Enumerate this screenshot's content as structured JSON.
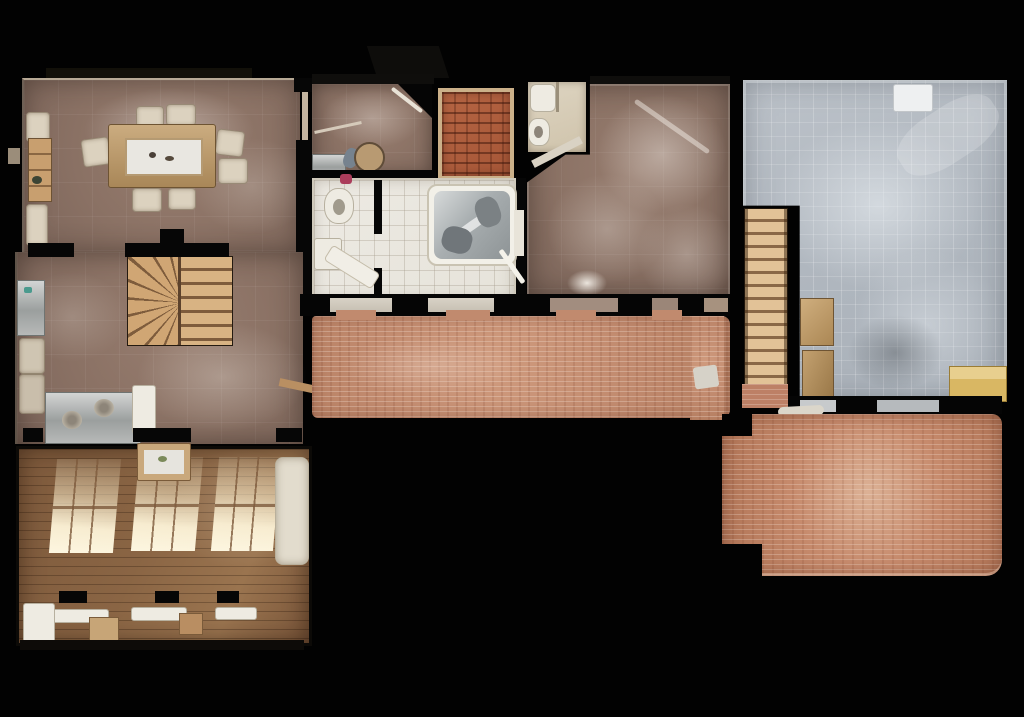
{
  "scene": {
    "kind": "3d-scan-dollhouse-floorplan-topdown",
    "background": "#020202",
    "visible_text": "none"
  },
  "palette": {
    "background": "#020202",
    "wall_black": "#060606",
    "wall_top_beige": "#c3b4a0",
    "mauve_tile_floor": "#8a7164",
    "wood_plank_floor": "#7b573a",
    "window_light": "#f9eecd",
    "white_tile_floor": "#e9e6df",
    "terracotta_rug": "#ae5e3d",
    "terracotta_border": "#cbb089",
    "brick_walkway": "#c18a6e",
    "brick_patio": "#bd7f62",
    "garage_concrete": "#b4bbc2",
    "stair_wood": "#d8b383",
    "stainless_steel": "#9b9f9e",
    "cream_furniture": "#dcd2bf",
    "hot_tub_cover": "#a8aeb0",
    "cardboard_box": "#c3a170",
    "yellow_object": "#d9b763",
    "pink_accent": "#ab3d5b"
  },
  "rooms": [
    {
      "id": "dining-room",
      "label": "Dining room",
      "floor": "mauve tile",
      "items": [
        "dining table with white runner",
        "six cream chairs",
        "sideboards",
        "wooden shelf unit"
      ]
    },
    {
      "id": "study-room",
      "label": "Study / utility room",
      "floor": "mauve tile",
      "items": [
        "round table",
        "steel sink",
        "mirror",
        "corner cut wall"
      ]
    },
    {
      "id": "terracotta-room",
      "label": "Terracotta rug room",
      "floor": "terracotta rug with grid"
    },
    {
      "id": "small-bathroom",
      "label": "Small bathroom",
      "floor": "cream tile",
      "items": [
        "sink",
        "toilet"
      ]
    },
    {
      "id": "spa-bathroom",
      "label": "Spa bathroom",
      "floor": "white tile",
      "items": [
        "hot tub with folded cover",
        "toilet",
        "vanity",
        "diagonal bench"
      ]
    },
    {
      "id": "hall-room",
      "label": "Hall",
      "floor": "mauve tile with light haze"
    },
    {
      "id": "kitchen-stair-hall",
      "label": "Kitchen / stair hall",
      "floor": "mauve tile",
      "items": [
        "winder staircase",
        "fridge",
        "steel counter with two sinks",
        "tall cabinet"
      ]
    },
    {
      "id": "living-room",
      "label": "Living room",
      "floor": "wood planks",
      "items": [
        "three sunlit window patches",
        "white sofa",
        "radiators",
        "stools",
        "island table"
      ]
    },
    {
      "id": "brick-walkway",
      "label": "Covered brick walkway",
      "floor": "salmon brick"
    },
    {
      "id": "straight-staircase",
      "label": "Straight staircase",
      "floor": "wood treads"
    },
    {
      "id": "garage",
      "label": "Garage",
      "floor": "gray concrete grid",
      "items": [
        "cardboard boxes",
        "yellow object",
        "white unit"
      ]
    },
    {
      "id": "brick-patio",
      "label": "Brick patio",
      "floor": "salmon brick"
    }
  ]
}
